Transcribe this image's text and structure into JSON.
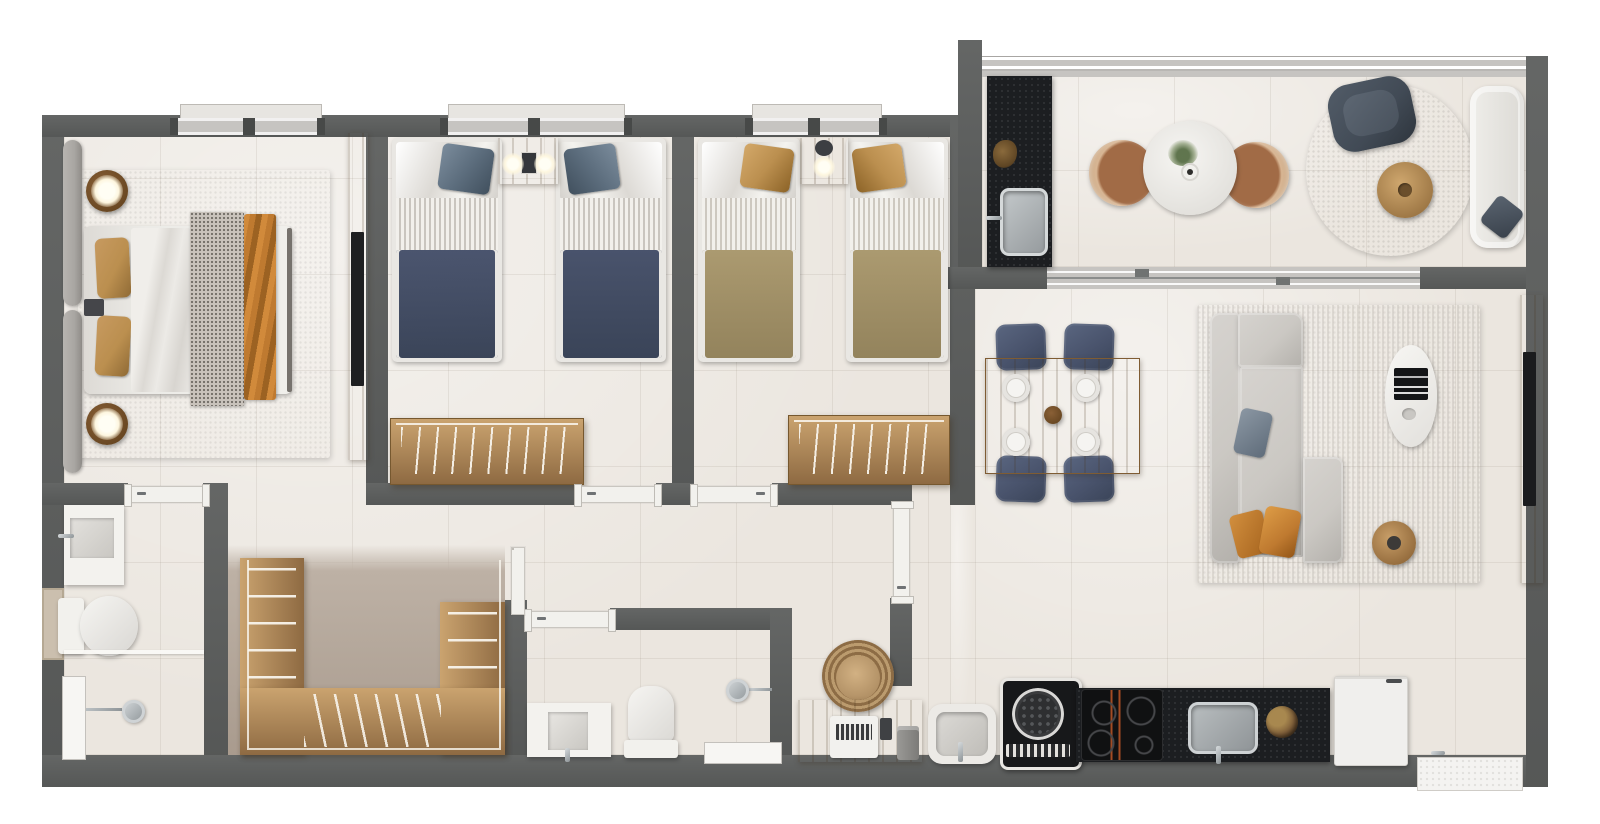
{
  "meta": {
    "title": "Apartment floor plan — 3D rendered top-down view",
    "canvas": {
      "width": 1600,
      "height": 824
    },
    "visible_text": []
  },
  "palette": {
    "wall": "#5c5e5d",
    "floor": "#ebe6df",
    "taupe": "#bdb1a5",
    "taupeDark": "#a99b8e",
    "wood": "#b3895a",
    "woodDark": "#8e6a42",
    "woodLight": "#caa36f",
    "navy": "#49536c",
    "navyDeep": "#3a4458",
    "steel": "#5d6e7e",
    "tanDuvet": "#ab9a70",
    "tanPillow": "#bb8f4f",
    "orange": "#bf7a30",
    "white": "#f2f1ed",
    "offWhite": "#e7e5e1",
    "grayFix": "#cfcdc9",
    "chrome": "#aab0b3",
    "chromeDeep": "#8d9396",
    "counterBlack": "#1c1e21",
    "applianceBlack": "#101112",
    "sofa": "#cbc8c3",
    "sofaDark": "#b3b0ab",
    "rug": "#cdc9c4",
    "rugRound": "#a9a49c",
    "rattan": "#a16b46",
    "rattanLight": "#d8b694",
    "slate": "#414a55",
    "glass": "#c6c4c1",
    "lamp": "#fdf6df",
    "headboard": "#a9a6a2",
    "speckle": "#c9c3bc"
  },
  "scene": {
    "rooms": [
      {
        "id": "master-bedroom",
        "furniture": [
          "double bed with white duvet, speckled gray runner and orange runner",
          "upholstered headboard (2 panels)",
          "2 round wood nightstands with lit lamps",
          "area rug",
          "wood media panel with TV"
        ]
      },
      {
        "id": "bedroom-2",
        "furniture": [
          "2 twin beds with navy duvets, striped sheets, steel-blue accent pillows",
          "shared wood headboard nightstand with 2 lamps",
          "open wood clothes rack"
        ]
      },
      {
        "id": "bedroom-3",
        "furniture": [
          "2 twin beds with tan duvets, striped sheets, tan accent pillows",
          "shared wood headboard nightstand with lamp",
          "open wood clothes rack"
        ]
      },
      {
        "id": "ensuite-bathroom",
        "furniture": [
          "vanity with square basin",
          "toilet",
          "glass shower screen",
          "shower head",
          "white ledge"
        ]
      },
      {
        "id": "walk-in-closet",
        "furniture": [
          "U-shaped wood wardrobe with rails and hangers"
        ]
      },
      {
        "id": "bathroom-2",
        "furniture": [
          "vanity with square basin",
          "toilet",
          "shower head",
          "white ledge"
        ]
      },
      {
        "id": "hallway",
        "furniture": [
          "doors to bedrooms, bathroom and living area"
        ]
      },
      {
        "id": "dining-area",
        "furniture": [
          "wood dining table",
          "4 navy chairs",
          "4 white place settings",
          "centerpiece"
        ]
      },
      {
        "id": "living-area",
        "furniture": [
          "L-shaped gray sofa with chaise",
          "gray pillow",
          "2 orange pillows",
          "large rug",
          "white oval coffee table with black magazine",
          "round wood side table",
          "wood TV panel with TV"
        ]
      },
      {
        "id": "kitchen-laundry",
        "furniture": [
          "white utility sink",
          "top-load washing machine",
          "black stone counter",
          "induction cooktop (4 burners)",
          "stainless sink",
          "fruit bowl",
          "white refrigerator",
          "outside service ledge with tap"
        ]
      },
      {
        "id": "home-office-nook",
        "furniture": [
          "wood desk",
          "white laptop",
          "phone",
          "canister",
          "round wicker chair"
        ]
      },
      {
        "id": "balcony",
        "furniture": [
          "black grill counter with stainless sink and plant",
          "round white dining table with vase",
          "2 round rattan chairs",
          "round gray rug",
          "slate swivel armchair",
          "round wood side table",
          "white lounge sofa with slate pillow",
          "glass railing",
          "sliding glass door"
        ]
      }
    ]
  }
}
